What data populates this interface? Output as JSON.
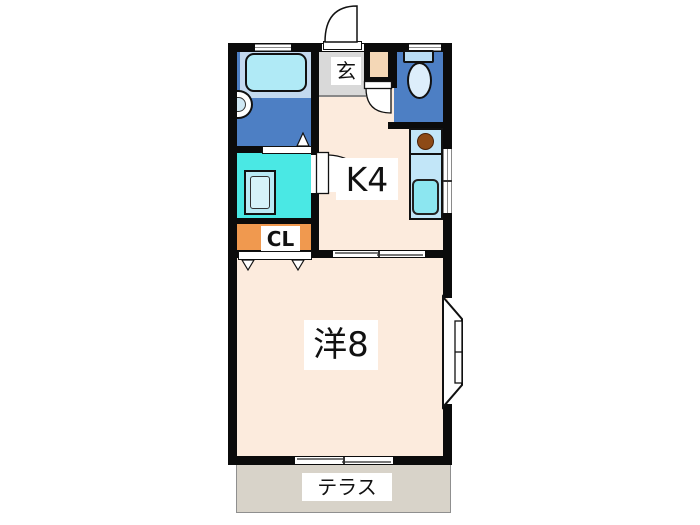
{
  "plan": {
    "type": "apartment-floorplan",
    "rooms": [
      {
        "id": "entrance",
        "label": "玄"
      },
      {
        "id": "kitchen",
        "label": "K4"
      },
      {
        "id": "closet",
        "label": "CL"
      },
      {
        "id": "western-room",
        "label": "洋8"
      },
      {
        "id": "terrace",
        "label": "テラス"
      }
    ],
    "fixtures": [
      {
        "id": "bathtub"
      },
      {
        "id": "washbasin"
      },
      {
        "id": "washing-machine"
      },
      {
        "id": "toilet"
      },
      {
        "id": "stove-burner"
      },
      {
        "id": "kitchen-sink"
      },
      {
        "id": "entrance-swing-door"
      },
      {
        "id": "toilet-swing-door"
      },
      {
        "id": "washroom-swing-door"
      },
      {
        "id": "bath-folding-door"
      },
      {
        "id": "closet-folding-door"
      },
      {
        "id": "room-sliding-door"
      },
      {
        "id": "bay-window"
      },
      {
        "id": "terrace-sliding-window"
      },
      {
        "id": "kitchen-side-window"
      },
      {
        "id": "bath-top-window"
      },
      {
        "id": "toilet-top-window"
      }
    ],
    "colors": {
      "page_bg": "#ffffff",
      "wall": "#0b0b0b",
      "floor": "#fcebdd",
      "wet_blue": "#4d7fc4",
      "tub_surround": "#c3d9ef",
      "bathtub": "#b0eaf6",
      "washroom": "#4ae8e4",
      "washer_body": "#b9eaf4",
      "washer_drum": "#d6f3f9",
      "closet": "#f0994f",
      "entrance_gray": "#d9d9d9",
      "step_tan": "#f4d7b6",
      "counter": "#c2e6f8",
      "sink": "#8ce6f0",
      "burner": "#8d4a16",
      "toilet_tank": "#b8dcf4",
      "toilet_bowl": "#ddeefb",
      "terrace": "#d8d3c9",
      "window_line": "#8a8a8a",
      "label_bg": "#ffffff",
      "text": "#111111"
    }
  }
}
